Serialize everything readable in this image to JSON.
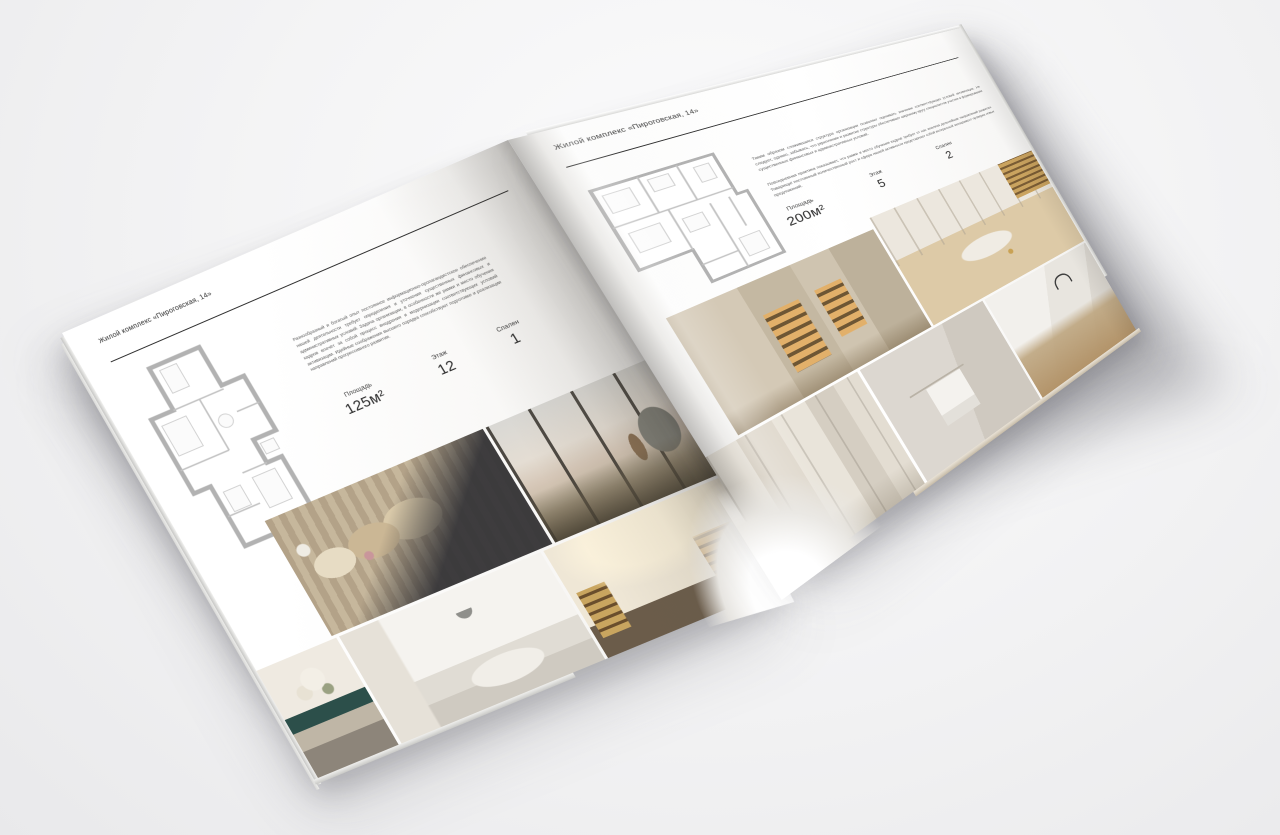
{
  "colors": {
    "backdrop": "#f2f2f3",
    "paper": "#ffffff",
    "ink": "#2e2e2e",
    "plan_line": "#b3b3b3",
    "glow_amber": "#d3a45f",
    "teal_console": "#2c4f4a"
  },
  "left_page": {
    "header": "Жилой комплекс «Пироговская, 14»",
    "description": "Разнообразный и богатый опыт постоянное информационно-пропагандистское обеспечение нашей деятельности требует определения и уточнения существенных финансовых и административных условий. Задача организации, в особенности же рамки и место обучения кадров влечёт за собой процесс внедрения и модернизации соответствующих условий активизации. Идейные соображения высшего порядка способствуют подготовке и реализации направлений прогрессивного развития.",
    "stats": [
      {
        "label": "Площадь",
        "value": "125м²"
      },
      {
        "label": "Этаж",
        "value": "12"
      },
      {
        "label": "Спален",
        "value": "1"
      }
    ],
    "photos": [
      "bedroom-with-pillows",
      "panoramic-living-room",
      "console-with-flowers",
      "white-bedroom",
      "library-hallway"
    ]
  },
  "right_page": {
    "header": "Жилой комплекс «Пироговская, 14»",
    "description_1": "Таким образом сложившаяся структура организации позволяет оценивать значение соответствующих условий активизации. Не следует, однако, забывать, что укрепление и развитие структуры обеспечивает широкому кругу специалистов участие в формировании существенных финансовых и административных условий.",
    "description_2": "Повседневная практика показывает, что рамки и место обучения кадров требует от нас анализа дальнейших направлений развития. Товарищи! постоянный количественный рост и сфера нашей активности представляет собой интересный эксперимент проверки новых предложений.",
    "stats": [
      {
        "label": "Площадь",
        "value": "200м²"
      },
      {
        "label": "Этаж",
        "value": "5"
      },
      {
        "label": "Спален",
        "value": "2"
      }
    ],
    "photos": [
      "illuminated-wardrobe",
      "dressing-room",
      "bathroom-corridor",
      "bathroom-towel-rail",
      "marble-washbasin"
    ]
  }
}
